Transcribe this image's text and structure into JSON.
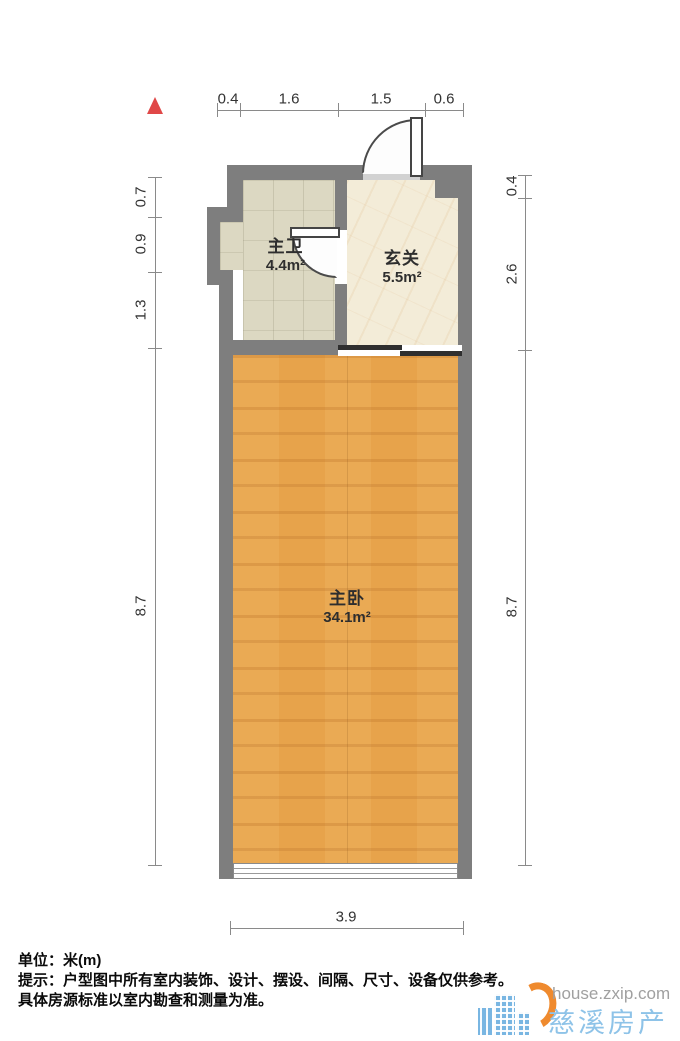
{
  "plan": {
    "rooms": [
      {
        "id": "bathroom",
        "name": "主卫",
        "area": "4.4m²"
      },
      {
        "id": "hallway",
        "name": "玄关",
        "area": "5.5m²"
      },
      {
        "id": "bedroom",
        "name": "主卧",
        "area": "34.1m²"
      }
    ],
    "dimensions": {
      "top": [
        "0.4",
        "1.6",
        "1.5",
        "0.6"
      ],
      "left": [
        "0.7",
        "0.9",
        "1.3",
        "8.7"
      ],
      "right": [
        "0.4",
        "2.6",
        "8.7"
      ],
      "bottom": [
        "3.9"
      ]
    }
  },
  "footer": {
    "unit_line": "单位：米(m)",
    "note_line1": "提示：户型图中所有室内装饰、设计、摆设、间隔、尺寸、设备仅供参考。",
    "note_line2": "具体房源标准以室内勘查和测量为准。"
  },
  "watermark": {
    "domain": "house.zxip.com",
    "site_name": "慈溪房产网"
  },
  "icons": {
    "north_arrow": "north-arrow",
    "logo": "city-buildings-logo"
  },
  "colors": {
    "wall": "#7e7e7e",
    "wood": "#e7a34b",
    "tile": "#dcd8c2",
    "marble": "#f3ecd8",
    "north_red": "#e04848",
    "dim_line": "#8a8a8a",
    "dim_text": "#333333",
    "logo_blue": "#79b6e2",
    "logo_orange": "#ef8a2e",
    "url_gray": "#a0a0a0",
    "site_blue": "#8ec3e8"
  }
}
